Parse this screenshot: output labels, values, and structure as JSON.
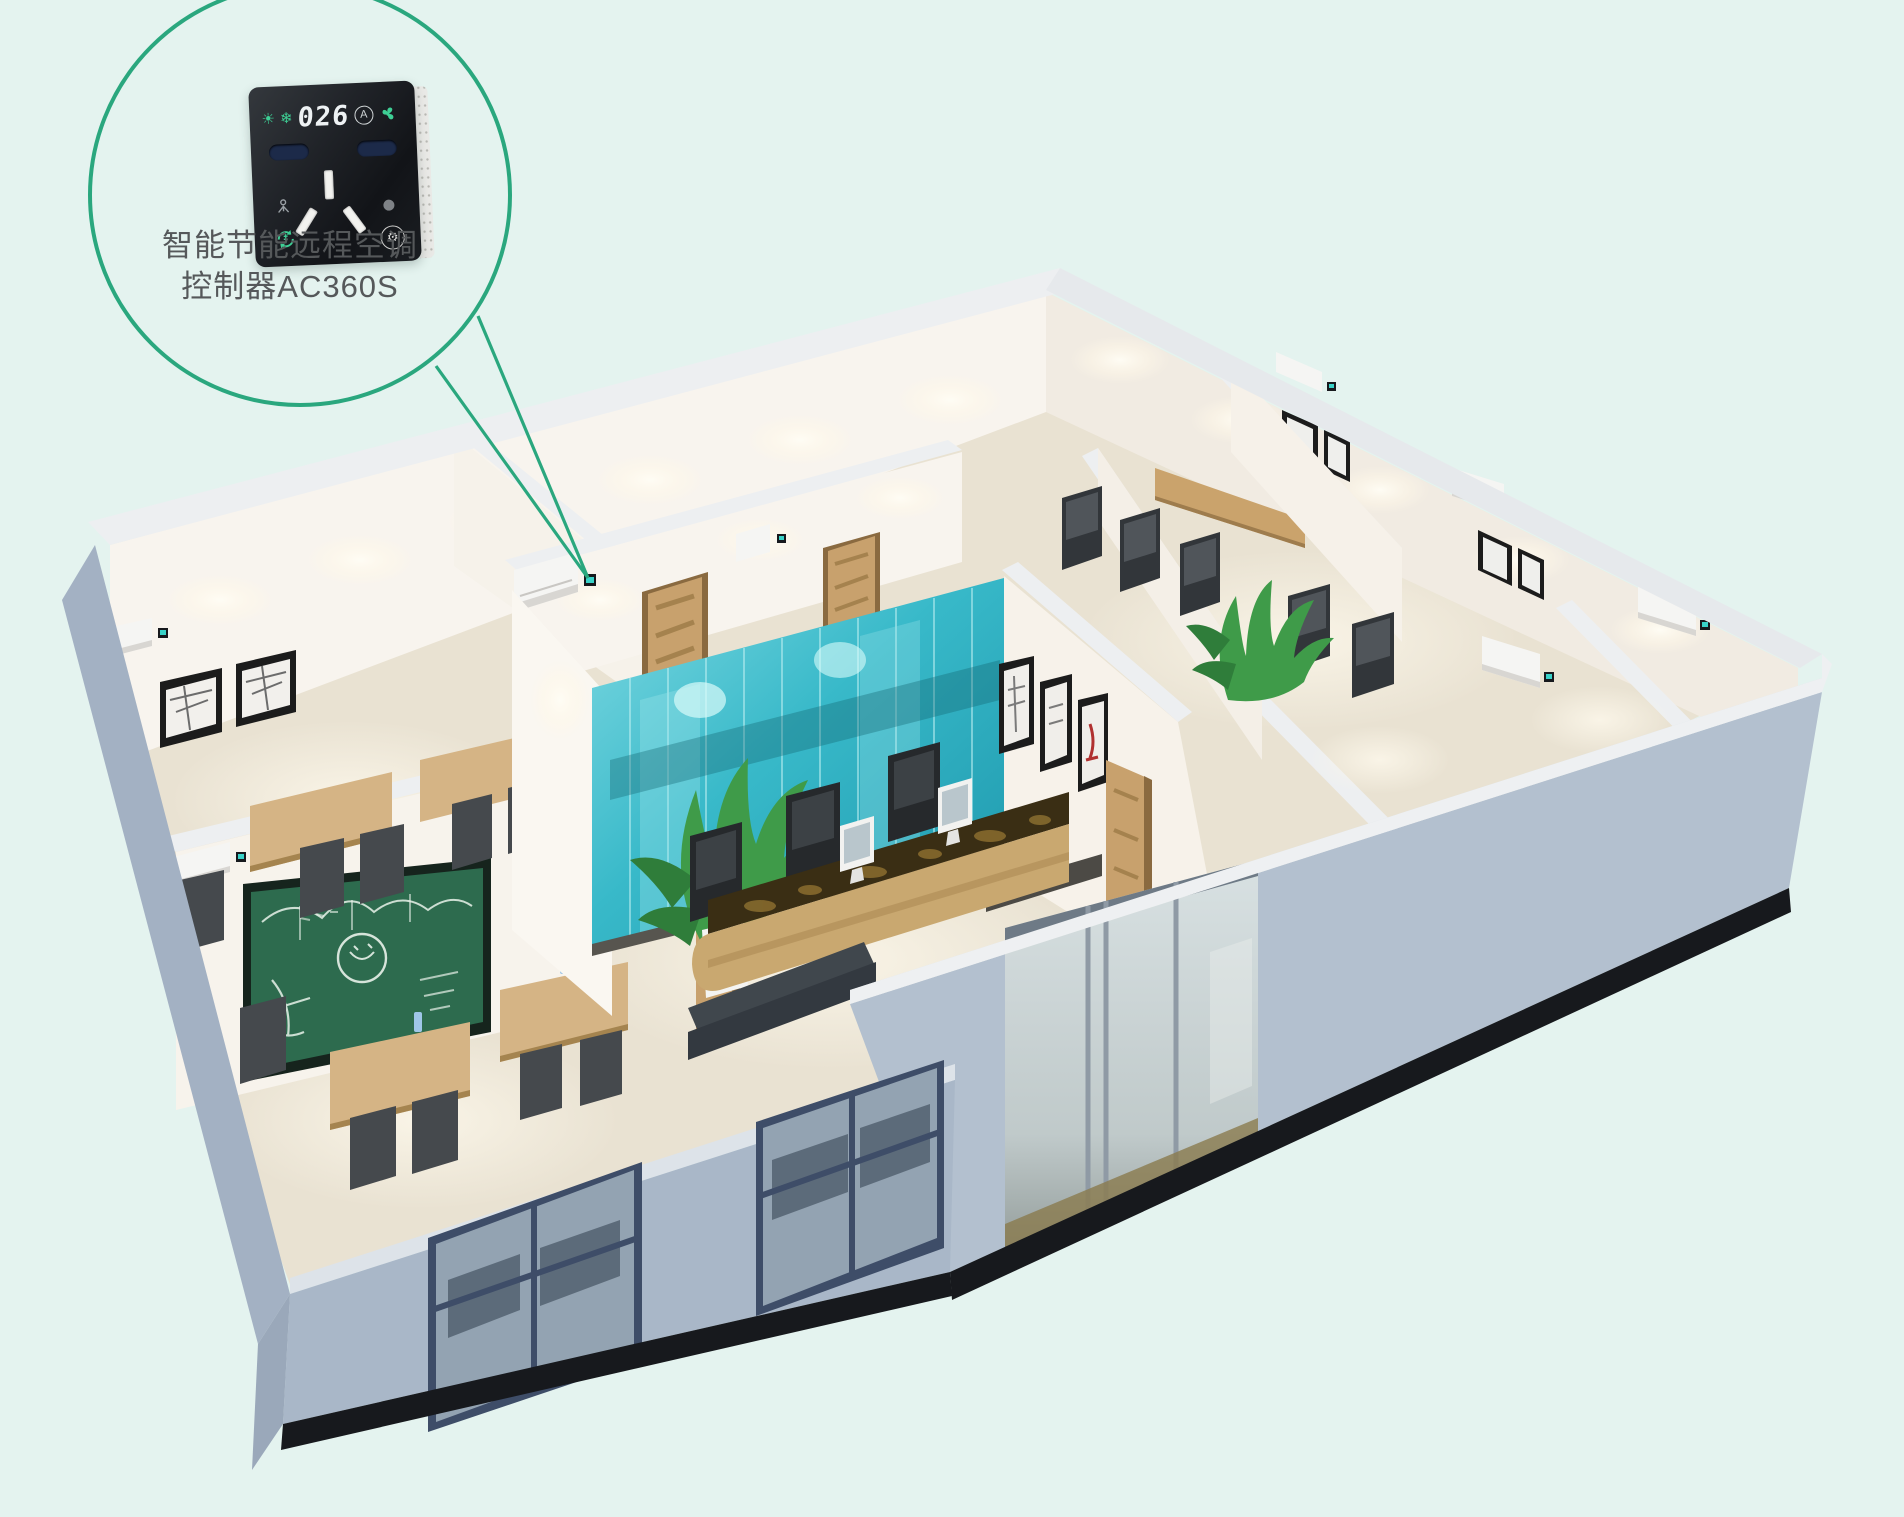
{
  "callout": {
    "label_line1": "智能节能远程空调",
    "label_line2": "控制器AC360S",
    "bubble_stroke": "#2aa77e",
    "text_color": "#55585a"
  },
  "device": {
    "display_value": "026",
    "mode_letter": "A",
    "body_color": "#17191d",
    "icon_green": "#3ecf95",
    "icons": [
      "sun-icon",
      "snowflake-icon",
      "auto-mode-icon",
      "fan-icon",
      "person-icon",
      "energy-cycle-icon",
      "indicator-dot",
      "gear-icon"
    ]
  },
  "scene": {
    "background_color": "#e4f3ef",
    "facade_color": "#a9b7c8",
    "facade_front_color": "#b3c0cf",
    "plinth_color": "#17191d",
    "wall_top_color": "#edeff1",
    "wall_lit_color": "#f8f4ee",
    "floor_color": "#e9e2d2",
    "glass_teal_color": "#38b9c9",
    "chalkboard_color": "#2d6b4e",
    "wood_color": "#c8a16d",
    "marble_color": "#3a2e14",
    "plant_color": "#3f9b49",
    "chair_color": "#3c4145",
    "ac_unit_color": "#f5f5f3",
    "controller_screen_color": "#39d2c8",
    "window_frame_color": "#3e4d68"
  }
}
